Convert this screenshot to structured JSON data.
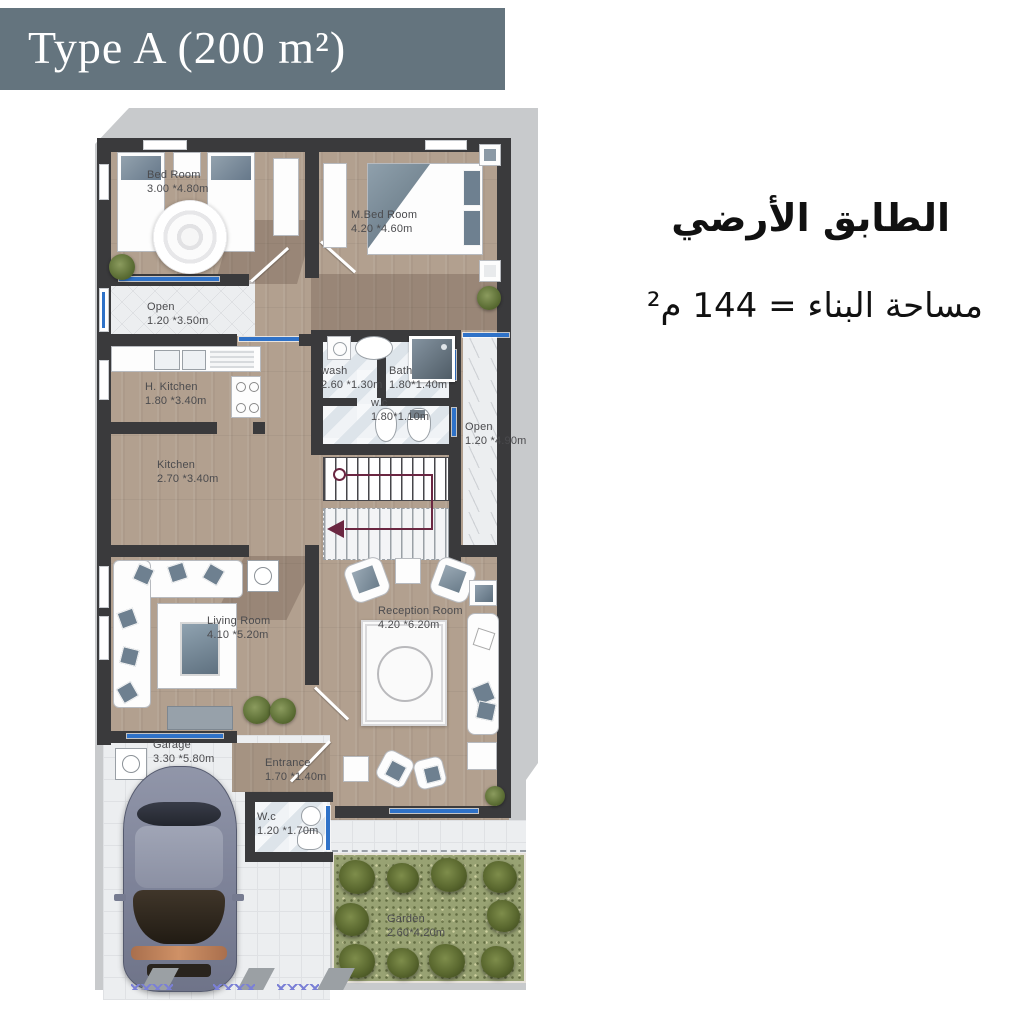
{
  "header": {
    "title": "Type A (200 m²)"
  },
  "annotation": {
    "line1": "الطابق الأرضي",
    "line2": "مساحة البناء = 144 م²"
  },
  "rooms": {
    "bedroom": {
      "name": "Bed Room",
      "dims": "3.00 *4.80m"
    },
    "master_bedroom": {
      "name": "M.Bed Room",
      "dims": "4.20 *4.60m"
    },
    "open_top": {
      "name": "Open",
      "dims": "1.20 *3.50m"
    },
    "house_kitchen": {
      "name": "H. Kitchen",
      "dims": "1.80 *3.40m"
    },
    "wash": {
      "name": "wash",
      "dims": "2.60 *1.30m"
    },
    "bath": {
      "name": "Bath",
      "dims": "1.80*1.40m"
    },
    "wc_small": {
      "name": "w.c",
      "dims": "1.80*1.10m"
    },
    "open_right": {
      "name": "Open",
      "dims": "1.20 *4.90m"
    },
    "kitchen": {
      "name": "Kitchen",
      "dims": "2.70 *3.40m"
    },
    "living_room": {
      "name": "Living  Room",
      "dims": "4.10 *5.20m"
    },
    "reception_room": {
      "name": "Reception Room",
      "dims": "4.20 *6.20m"
    },
    "garage": {
      "name": "Garage",
      "dims": "3.30 *5.80m"
    },
    "entrance": {
      "name": "Entrance",
      "dims": "1.70 *1.40m"
    },
    "wc": {
      "name": "W.c",
      "dims": "1.20 *1.70m"
    },
    "garden": {
      "name": "Garden",
      "dims": "2.60*4.20m"
    }
  },
  "colors": {
    "header_bg": "#64747E",
    "wall": "#3A3A3C",
    "wood": "#B2A08F",
    "tile": "#ECEEF0",
    "garden_green": "#98A273",
    "window_blue": "#2F72C8",
    "stair_route": "#6B2742",
    "label_text": "#4B4B4E"
  }
}
